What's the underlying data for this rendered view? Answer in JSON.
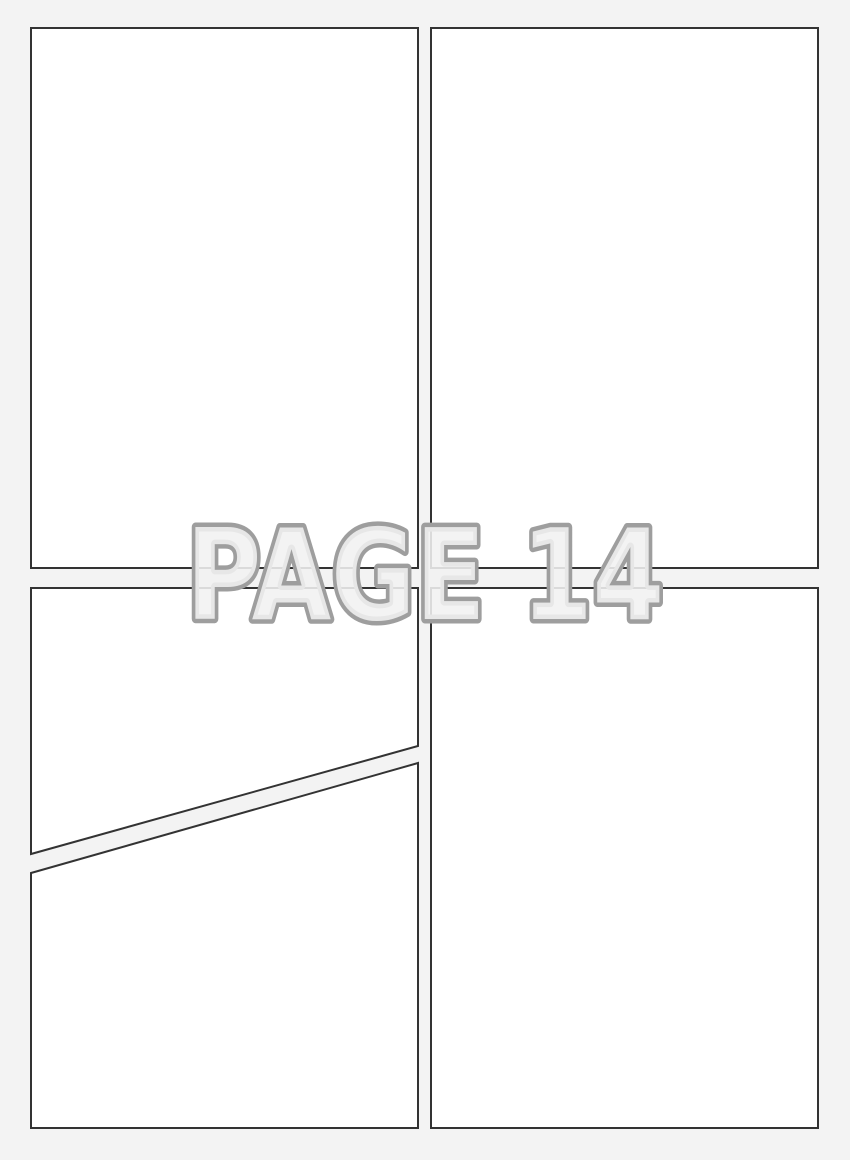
{
  "page_label": "PAGE 14",
  "colors": {
    "background": "#f3f3f3",
    "panel_fill": "#ffffff",
    "panel_border": "#333333",
    "label_fill": "#f1f1f1",
    "label_outline": "#9e9e9e"
  },
  "panels": [
    {
      "id": "top-left"
    },
    {
      "id": "top-right"
    },
    {
      "id": "bottom-left-upper"
    },
    {
      "id": "bottom-left-lower"
    },
    {
      "id": "bottom-right"
    }
  ]
}
